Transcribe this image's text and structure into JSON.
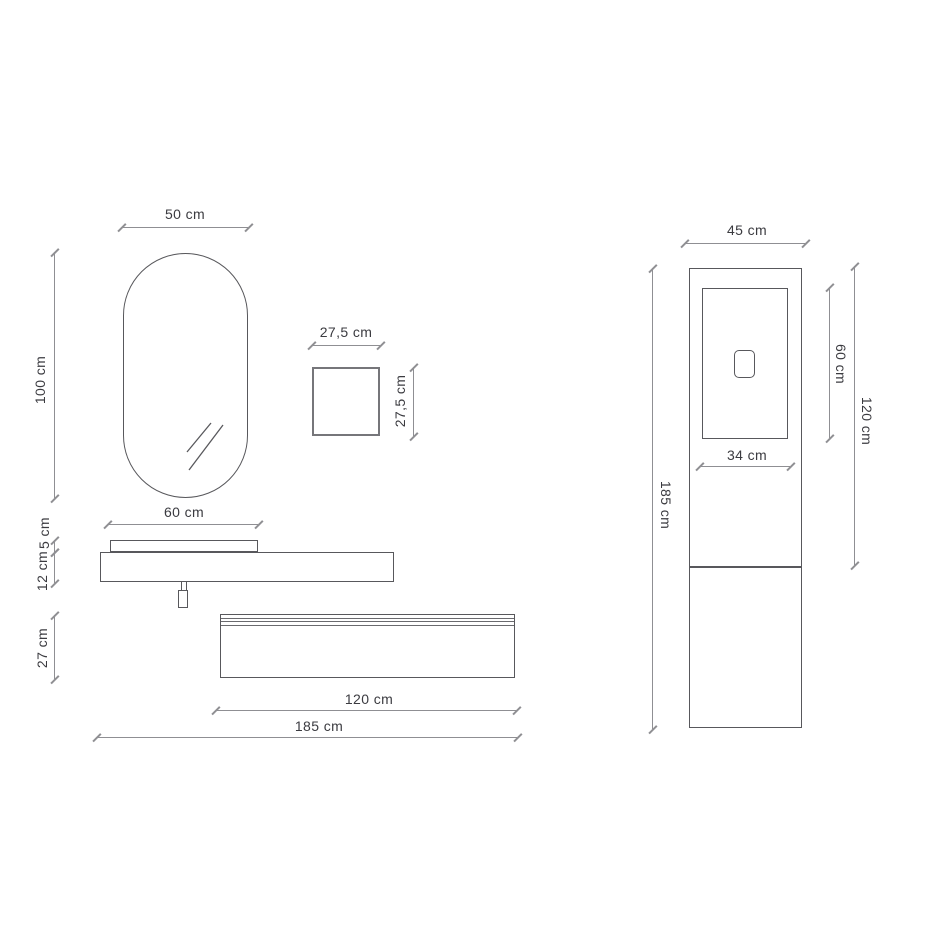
{
  "diagram": {
    "title": "bathroom-vanity-technical-drawing",
    "colors": {
      "background": "#ffffff",
      "object_stroke": "#58585c",
      "dimension_line": "#8f8f93",
      "label_text": "#3b3b40"
    },
    "left_figure": {
      "labels": {
        "mirror_width": "50 cm",
        "mirror_height": "100 cm",
        "box_width": "27,5 cm",
        "box_height": "27,5 cm",
        "basin_width": "60 cm",
        "basin_rim_height": "5 cm",
        "countertop_height": "12 cm",
        "wall_unit_height": "27 cm",
        "wall_unit_width": "120 cm",
        "total_width": "185 cm"
      }
    },
    "right_figure": {
      "labels": {
        "column_width": "45 cm",
        "column_height": "185 cm",
        "door_height": "60 cm",
        "upper_section_height": "120 cm",
        "door_width": "34 cm"
      }
    }
  }
}
